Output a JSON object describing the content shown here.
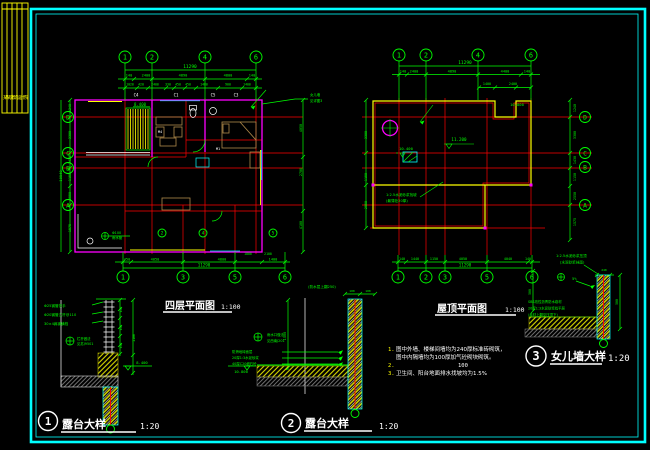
{
  "colors": {
    "g": "#00ff00",
    "r": "#ff0000",
    "y": "#ffff00",
    "c": "#00ffff",
    "m": "#ff00ff",
    "w": "#ffffff",
    "t": "#b08a4a"
  },
  "strip": {
    "text": "某某建筑设计院"
  },
  "plans": {
    "floor4": {
      "title": "四层平面图",
      "scale": "1:100"
    },
    "roof": {
      "title": "屋顶平面图",
      "scale": "1:100"
    }
  },
  "details": [
    {
      "num": "1",
      "title": "露台大样",
      "scale": "1:20"
    },
    {
      "num": "2",
      "title": "露台大样",
      "scale": "1:20"
    },
    {
      "num": "3",
      "title": "女儿墙大样",
      "scale": "1:20"
    }
  ],
  "notes": {
    "n1": "1.",
    "l1": "图中外墙、楼梯间墙均为240厚标准砖砌筑，",
    "l2": "图中内隔墙均为100厚加气砼砌块砌筑。",
    "n2": "2.",
    "l3": "100",
    "n3": "3.",
    "l4": "卫生间、阳台地面排水找坡均为1.5%"
  },
  "gen": {
    "texts": [
      {
        "x": 190,
        "y": 68,
        "t": "11290",
        "s": 4.5
      },
      {
        "x": 129,
        "y": 76.5,
        "t": "140",
        "s": 3.6
      },
      {
        "x": 146,
        "y": 76.5,
        "t": "2400",
        "s": 3.6
      },
      {
        "x": 183,
        "y": 76.5,
        "t": "4890",
        "s": 3.6
      },
      {
        "x": 228,
        "y": 76.5,
        "t": "4800",
        "s": 3.6
      },
      {
        "x": 252,
        "y": 76.5,
        "t": "140",
        "s": 3.6
      },
      {
        "x": 130,
        "y": 85.5,
        "t": "1020",
        "s": 3.2
      },
      {
        "x": 141,
        "y": 85.5,
        "t": "420",
        "s": 3.2
      },
      {
        "x": 155,
        "y": 85.5,
        "t": "2400",
        "s": 3.2
      },
      {
        "x": 168,
        "y": 85.5,
        "t": "330",
        "s": 3.2
      },
      {
        "x": 178,
        "y": 85.5,
        "t": "450",
        "s": 3.2
      },
      {
        "x": 188,
        "y": 85.5,
        "t": "450",
        "s": 3.2
      },
      {
        "x": 204,
        "y": 85.5,
        "t": "1480",
        "s": 3.2
      },
      {
        "x": 228,
        "y": 85.5,
        "t": "900",
        "s": 3.2
      },
      {
        "x": 247,
        "y": 85.5,
        "t": "1400",
        "s": 3.2
      },
      {
        "x": 136,
        "y": 96.5,
        "t": "C4",
        "s": 4,
        "c": "w"
      },
      {
        "x": 176,
        "y": 96.5,
        "t": "C1",
        "s": 4,
        "c": "w"
      },
      {
        "x": 213,
        "y": 96.5,
        "t": "C5",
        "s": 4,
        "c": "w"
      },
      {
        "x": 236,
        "y": 96.5,
        "t": "C3",
        "s": 4,
        "c": "w"
      },
      {
        "x": 140,
        "y": 106,
        "t": "8.400",
        "s": 4
      },
      {
        "x": 160,
        "y": 133,
        "t": "M4",
        "s": 3.6,
        "c": "w"
      },
      {
        "x": 218,
        "y": 150,
        "t": "M1",
        "s": 3.6,
        "c": "w"
      },
      {
        "x": 248,
        "y": 255,
        "t": "1800",
        "s": 3.2
      },
      {
        "x": 268,
        "y": 255,
        "t": "2100",
        "s": 3.2
      },
      {
        "x": 127,
        "y": 260.5,
        "t": "450",
        "s": 3.6
      },
      {
        "x": 155,
        "y": 260.5,
        "t": "4050",
        "s": 3.6
      },
      {
        "x": 222,
        "y": 260.5,
        "t": "4800",
        "s": 3.6
      },
      {
        "x": 273,
        "y": 260.5,
        "t": "1400",
        "s": 3.6
      },
      {
        "x": 204,
        "y": 266.5,
        "t": "11290",
        "s": 4.2
      },
      {
        "x": 71,
        "y": 108,
        "t": "1240",
        "s": 3.4,
        "rot": -90
      },
      {
        "x": 71,
        "y": 135,
        "t": "3300",
        "s": 3.4,
        "rot": -90
      },
      {
        "x": 71,
        "y": 160,
        "t": "1430",
        "s": 3.4,
        "rot": -90
      },
      {
        "x": 71,
        "y": 177,
        "t": "1150",
        "s": 3.4,
        "rot": -90
      },
      {
        "x": 71,
        "y": 196,
        "t": "2550",
        "s": 3.4,
        "rot": -90
      },
      {
        "x": 71,
        "y": 228,
        "t": "1575",
        "s": 3.4,
        "rot": -90
      },
      {
        "x": 62,
        "y": 176,
        "t": "10940",
        "s": 3.8,
        "rot": -90
      },
      {
        "x": 302,
        "y": 128,
        "t": "4050",
        "s": 3.4,
        "rot": -90
      },
      {
        "x": 302,
        "y": 172,
        "t": "2700",
        "s": 3.4,
        "rot": -90
      },
      {
        "x": 302,
        "y": 225,
        "t": "4100",
        "s": 3.4,
        "rot": -90
      },
      {
        "x": 310,
        "y": 96,
        "t": "女儿墙",
        "s": 3.4,
        "a": "start"
      },
      {
        "x": 310,
        "y": 102,
        "t": "见详图3",
        "s": 3.4,
        "a": "start"
      },
      {
        "x": 112,
        "y": 234,
        "t": "Φ100",
        "s": 3.4,
        "a": "start"
      },
      {
        "x": 112,
        "y": 239,
        "t": "雨水管",
        "s": 3.4,
        "a": "start"
      },
      {
        "x": 465,
        "y": 64,
        "t": "11290",
        "s": 4.5
      },
      {
        "x": 403,
        "y": 72.5,
        "t": "140",
        "s": 3.6
      },
      {
        "x": 414,
        "y": 72.5,
        "t": "2400",
        "s": 3.6
      },
      {
        "x": 452,
        "y": 72.5,
        "t": "4890",
        "s": 3.6
      },
      {
        "x": 505,
        "y": 72.5,
        "t": "4400",
        "s": 3.6
      },
      {
        "x": 527,
        "y": 72.5,
        "t": "140",
        "s": 3.6
      },
      {
        "x": 487,
        "y": 85,
        "t": "1400",
        "s": 3.4
      },
      {
        "x": 513,
        "y": 85,
        "t": "2400",
        "s": 3.4
      },
      {
        "x": 367,
        "y": 135,
        "t": "3300",
        "s": 3.4,
        "rot": -90
      },
      {
        "x": 367,
        "y": 177,
        "t": "1150",
        "s": 3.4,
        "rot": -90
      },
      {
        "x": 367,
        "y": 205,
        "t": "2550",
        "s": 3.4,
        "rot": -90
      },
      {
        "x": 576,
        "y": 108,
        "t": "1240",
        "s": 3.4,
        "rot": -90
      },
      {
        "x": 576,
        "y": 135,
        "t": "3300",
        "s": 3.4,
        "rot": -90
      },
      {
        "x": 576,
        "y": 160,
        "t": "1430",
        "s": 3.4,
        "rot": -90
      },
      {
        "x": 576,
        "y": 177,
        "t": "1150",
        "s": 3.4,
        "rot": -90
      },
      {
        "x": 576,
        "y": 196,
        "t": "2550",
        "s": 3.4,
        "rot": -90
      },
      {
        "x": 576,
        "y": 222,
        "t": "1575",
        "s": 3.4,
        "rot": -90
      },
      {
        "x": 459,
        "y": 141,
        "t": "11.200",
        "s": 4.2
      },
      {
        "x": 517,
        "y": 106,
        "t": "10.800",
        "s": 3.8
      },
      {
        "x": 406,
        "y": 150,
        "t": "10.400",
        "s": 3.8
      },
      {
        "x": 386,
        "y": 196,
        "t": "1:2.5水泥砂浆找坡",
        "s": 3.6,
        "a": "start"
      },
      {
        "x": 386,
        "y": 202,
        "t": "(最薄处20厚)",
        "s": 3.6,
        "a": "start"
      },
      {
        "x": 402,
        "y": 260,
        "t": "140",
        "s": 3.4
      },
      {
        "x": 415,
        "y": 260,
        "t": "1440",
        "s": 3.4
      },
      {
        "x": 434,
        "y": 260,
        "t": "1150",
        "s": 3.4
      },
      {
        "x": 463,
        "y": 260,
        "t": "4050",
        "s": 3.4
      },
      {
        "x": 508,
        "y": 260,
        "t": "4040",
        "s": 3.4
      },
      {
        "x": 528,
        "y": 260,
        "t": "140",
        "s": 3.4
      },
      {
        "x": 465,
        "y": 266.5,
        "t": "11290",
        "s": 4.2
      },
      {
        "x": 44,
        "y": 307,
        "t": "Φ25钢管扶手",
        "s": 3.6,
        "a": "start"
      },
      {
        "x": 44,
        "y": 316,
        "t": "Φ20钢管立杆@110",
        "s": 3.6,
        "a": "start"
      },
      {
        "x": 44,
        "y": 325,
        "t": "30×4扁钢横档",
        "s": 3.6,
        "a": "start"
      },
      {
        "x": 77,
        "y": 340,
        "t": "栏杆做法",
        "s": 3.4,
        "a": "start"
      },
      {
        "x": 77,
        "y": 345,
        "t": "见苏J9501",
        "s": 3.4,
        "a": "start"
      },
      {
        "x": 122,
        "y": 310,
        "t": "110",
        "s": 2.8,
        "rot": -90
      },
      {
        "x": 122,
        "y": 328,
        "t": "110",
        "s": 2.8,
        "rot": -90
      },
      {
        "x": 122,
        "y": 346,
        "t": "110",
        "s": 2.8,
        "rot": -90
      },
      {
        "x": 135,
        "y": 338,
        "t": "1100",
        "s": 3.2,
        "rot": -90
      },
      {
        "x": 142,
        "y": 364,
        "t": "8.400",
        "s": 3.8
      },
      {
        "x": 322,
        "y": 288,
        "t": "(防水层上翻250)",
        "s": 3.6
      },
      {
        "x": 352,
        "y": 292,
        "t": "100",
        "s": 3
      },
      {
        "x": 368,
        "y": 292,
        "t": "100",
        "s": 3
      },
      {
        "x": 286,
        "y": 336,
        "t": "1500",
        "s": 3.6,
        "rot": -90
      },
      {
        "x": 267,
        "y": 336,
        "t": "雨水口做法",
        "s": 3.4,
        "a": "start"
      },
      {
        "x": 267,
        "y": 342,
        "t": "见西南J201",
        "s": 3.4,
        "a": "start"
      },
      {
        "x": 232,
        "y": 353,
        "t": "防滑地砖面层",
        "s": 3.4,
        "a": "start"
      },
      {
        "x": 232,
        "y": 359,
        "t": "20厚1:3水泥砂浆",
        "s": 3.4,
        "a": "start"
      },
      {
        "x": 232,
        "y": 365,
        "t": "40厚C20细石砼",
        "s": 3.4,
        "a": "start"
      },
      {
        "x": 241,
        "y": 373,
        "t": "10.800",
        "s": 3.8
      },
      {
        "x": 556,
        "y": 257,
        "t": "1:2.5水泥砂浆压顶",
        "s": 3.6,
        "a": "start"
      },
      {
        "x": 560,
        "y": 263.5,
        "t": "(水泥砂浆抹面)",
        "s": 3.6,
        "a": "start"
      },
      {
        "x": 604,
        "y": 271,
        "t": "240",
        "s": 3
      },
      {
        "x": 572,
        "y": 280,
        "t": "5%",
        "s": 3.8,
        "a": "start"
      },
      {
        "x": 531,
        "y": 292,
        "t": "500",
        "s": 3.2,
        "rot": -90
      },
      {
        "x": 618,
        "y": 302,
        "t": "500",
        "s": 3.2,
        "rot": -90
      },
      {
        "x": 528,
        "y": 303,
        "t": "SBS改性沥青防水卷材",
        "s": 3.4,
        "a": "start"
      },
      {
        "x": 528,
        "y": 309.5,
        "t": "20厚1:3水泥砂浆找平层",
        "s": 3.4,
        "a": "start"
      },
      {
        "x": 528,
        "y": 316,
        "t": "(卷材上翻至压顶下)",
        "s": 3.4,
        "a": "start"
      }
    ],
    "bubbles": [
      {
        "x": 125,
        "y": 57,
        "t": "1"
      },
      {
        "x": 152,
        "y": 57,
        "t": "2"
      },
      {
        "x": 205,
        "y": 57,
        "t": "4"
      },
      {
        "x": 256,
        "y": 57,
        "t": "6"
      },
      {
        "x": 123,
        "y": 277,
        "t": "1"
      },
      {
        "x": 183,
        "y": 277,
        "t": "3"
      },
      {
        "x": 235,
        "y": 277,
        "t": "5"
      },
      {
        "x": 285,
        "y": 277,
        "t": "6"
      },
      {
        "x": 68,
        "y": 117,
        "t": "D",
        "r": 5.5
      },
      {
        "x": 68,
        "y": 153,
        "t": "C",
        "r": 5.5
      },
      {
        "x": 68,
        "y": 168,
        "t": "B",
        "r": 5.5
      },
      {
        "x": 68,
        "y": 205,
        "t": "A",
        "r": 5.5
      },
      {
        "x": 162,
        "y": 233,
        "t": "2",
        "r": 4
      },
      {
        "x": 203,
        "y": 233,
        "t": "4",
        "r": 4
      },
      {
        "x": 273,
        "y": 233,
        "t": "5",
        "r": 4
      },
      {
        "x": 399,
        "y": 55,
        "t": "1"
      },
      {
        "x": 426,
        "y": 55,
        "t": "2"
      },
      {
        "x": 478,
        "y": 55,
        "t": "4"
      },
      {
        "x": 531,
        "y": 55,
        "t": "6"
      },
      {
        "x": 398,
        "y": 277,
        "t": "1"
      },
      {
        "x": 426,
        "y": 277,
        "t": "2"
      },
      {
        "x": 445,
        "y": 277,
        "t": "3"
      },
      {
        "x": 487,
        "y": 277,
        "t": "5"
      },
      {
        "x": 532,
        "y": 277,
        "t": "6"
      },
      {
        "x": 585,
        "y": 117,
        "t": "D",
        "r": 5.5
      },
      {
        "x": 585,
        "y": 153,
        "t": "C",
        "r": 5.5
      },
      {
        "x": 585,
        "y": 167,
        "t": "B",
        "r": 5.5
      },
      {
        "x": 585,
        "y": 205,
        "t": "A",
        "r": 5.5
      }
    ]
  }
}
